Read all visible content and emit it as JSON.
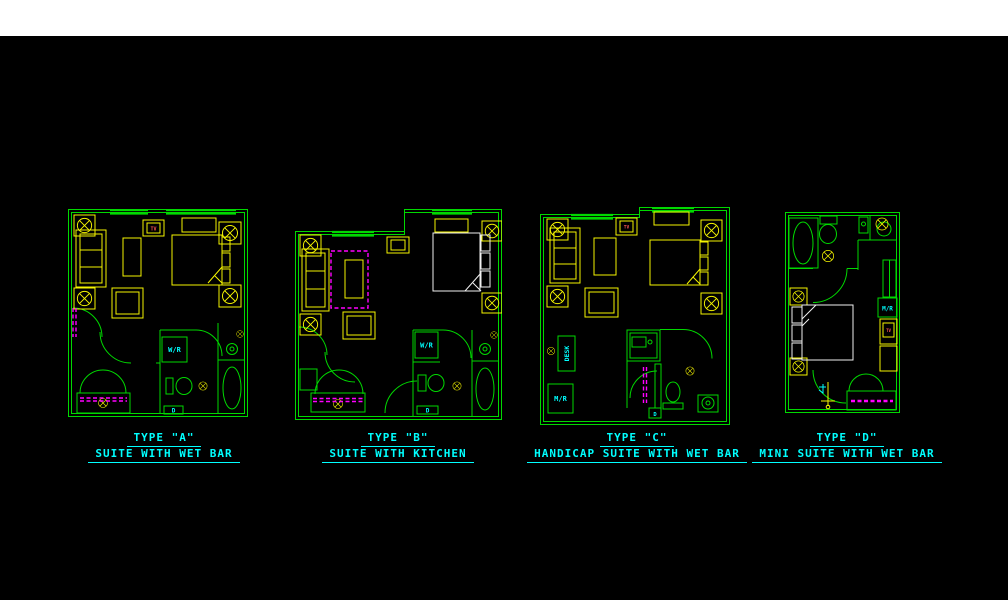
{
  "drawing": {
    "background": "#000000",
    "paper_strip_color": "#ffffff",
    "colors": {
      "wall_green": "#00d900",
      "furniture_yellow": "#f5f500",
      "label_cyan": "#00ffff",
      "dashed_magenta": "#ff00ff",
      "linen_white": "#f0f0f0",
      "tv_red": "#ff5555"
    }
  },
  "plans": [
    {
      "title_line1": "TYPE \"A\"",
      "title_line2": "SUITE WITH WET BAR",
      "labels": {
        "wet_bar": "W/R",
        "tv": "TV",
        "door_tag": "D"
      }
    },
    {
      "title_line1": "TYPE \"B\"",
      "title_line2": "SUITE WITH KITCHEN",
      "labels": {
        "wet_bar": "W/R",
        "door_tag": "D"
      }
    },
    {
      "title_line1": "TYPE \"C\"",
      "title_line2": "HANDICAP SUITE WITH WET BAR",
      "labels": {
        "desk": "DESK",
        "mini_fridge": "M/R",
        "tv": "TV",
        "door_tag": "D"
      }
    },
    {
      "title_line1": "TYPE \"D\"",
      "title_line2": "MINI SUITE WITH WET BAR",
      "labels": {
        "mini_fridge": "M/R",
        "tv": "TV"
      }
    }
  ]
}
